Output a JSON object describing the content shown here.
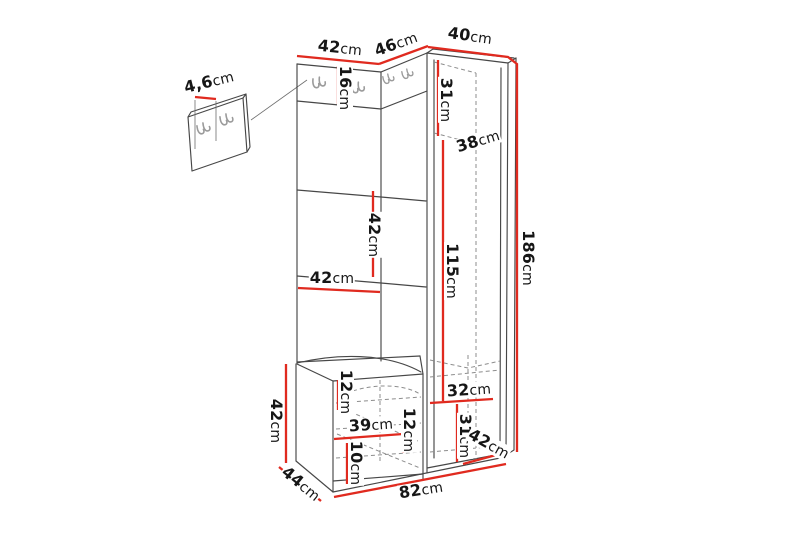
{
  "diagram": {
    "type": "furniture-dimension-drawing",
    "subject": "corner hallway unit with coat hooks, wardrobe and shoe bench",
    "unit": "cm",
    "colors": {
      "dimension_lines": "#e02a1f",
      "outline": "#474747",
      "hidden_lines": "#8d8d8d",
      "hooks": "#9b9b9b",
      "background": "#ffffff"
    },
    "measurements": {
      "top_panel_width": {
        "value": "42",
        "unit": "cm"
      },
      "corner_section_width": {
        "value": "46",
        "unit": "cm"
      },
      "wardrobe_top_width": {
        "value": "40",
        "unit": "cm"
      },
      "hook_strip_height": {
        "value": "16",
        "unit": "cm"
      },
      "hook_panel_depth": {
        "value": "4,6",
        "unit": "cm"
      },
      "wardrobe_upper_space_height": {
        "value": "31",
        "unit": "cm"
      },
      "wardrobe_shelf_depth": {
        "value": "38",
        "unit": "cm"
      },
      "panel_middle_section_height": {
        "value": "42",
        "unit": "cm"
      },
      "panel_middle_width": {
        "value": "42",
        "unit": "cm"
      },
      "hanging_space_height": {
        "value": "115",
        "unit": "cm"
      },
      "total_height": {
        "value": "186",
        "unit": "cm"
      },
      "bench_seat_thickness": {
        "value": "12",
        "unit": "cm"
      },
      "bench_height": {
        "value": "42",
        "unit": "cm"
      },
      "bench_interior_width": {
        "value": "39",
        "unit": "cm"
      },
      "bench_middle_space_height": {
        "value": "12",
        "unit": "cm"
      },
      "bench_bottom_space_height": {
        "value": "10",
        "unit": "cm"
      },
      "wardrobe_interior_width": {
        "value": "32",
        "unit": "cm"
      },
      "wardrobe_bottom_space_height": {
        "value": "31",
        "unit": "cm"
      },
      "wardrobe_depth": {
        "value": "42",
        "unit": "cm"
      },
      "bench_depth": {
        "value": "44",
        "unit": "cm"
      },
      "total_width": {
        "value": "82",
        "unit": "cm"
      }
    }
  }
}
